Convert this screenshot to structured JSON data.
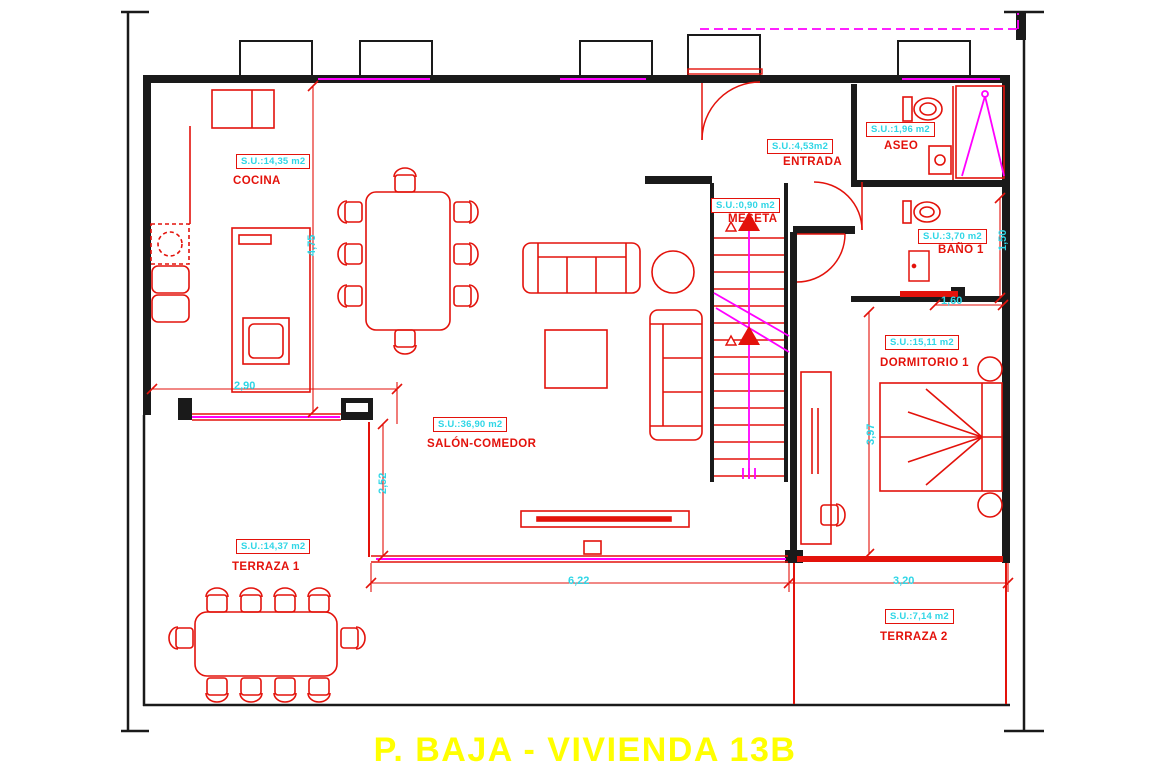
{
  "title": "P. BAJA - VIVIENDA 13B",
  "colors": {
    "wall": "#1a1a1a",
    "drawing_red": "#e3120b",
    "dimension_cyan": "#2fd6e6",
    "accent_magenta": "#ff00ff",
    "title_yellow": "#ffff00",
    "background": "#ffffff"
  },
  "rooms": [
    {
      "id": "cocina",
      "name": "COCINA",
      "area": "S.U.:14,35 m2"
    },
    {
      "id": "entrada",
      "name": "ENTRADA",
      "area": "S.U.:4,53m2"
    },
    {
      "id": "aseo",
      "name": "ASEO",
      "area": "S.U.:1,96 m2"
    },
    {
      "id": "meseta",
      "name": "MESETA",
      "area": "S.U.:0,90 m2"
    },
    {
      "id": "bano-1",
      "name": "BAÑO 1",
      "area": "S.U.:3,70 m2"
    },
    {
      "id": "dormitorio-1",
      "name": "DORMITORIO 1",
      "area": "S.U.:15,11 m2"
    },
    {
      "id": "salon-comedor",
      "name": "SALÓN-COMEDOR",
      "area": "S.U.:36,90 m2"
    },
    {
      "id": "terraza-1",
      "name": "TERRAZA 1",
      "area": "S.U.:14,37 m2"
    },
    {
      "id": "terraza-2",
      "name": "TERRAZA 2",
      "area": "S.U.:7,14 m2"
    }
  ],
  "dimensions": {
    "cocina_height": "4,75",
    "cocina_width": "2,90",
    "salon_terraza_edge": "2,52",
    "salon_width": "6,22",
    "terraza2_width": "3,20",
    "dormitorio_height": "3,97",
    "bano_width": "1,60",
    "bano_height": "1,50"
  }
}
